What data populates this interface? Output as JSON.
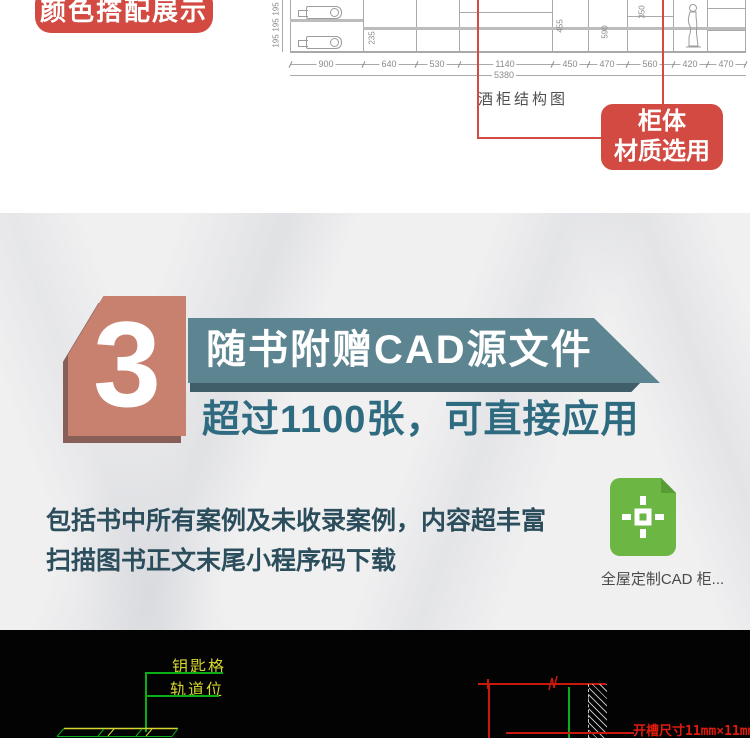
{
  "top": {
    "badge": "颜色搭配展示",
    "cad": {
      "caption": "酒柜结构图",
      "dims": [
        "900",
        "640",
        "530",
        "1140",
        "450",
        "470",
        "560",
        "420",
        "470"
      ],
      "total": "5380",
      "side_dims": [
        "195",
        "195",
        "195"
      ],
      "inner_dims": [
        "235",
        "455",
        "590",
        "350"
      ]
    },
    "material_label": {
      "line1": "柜体",
      "line2": "材质选用"
    }
  },
  "feature": {
    "number": "3",
    "banner": "随书附赠CAD源文件",
    "subtitle": "超过1100张，可直接应用",
    "body_line1": "包括书中所有案例及未收录案例，内容超丰富",
    "body_line2": "扫描图书正文末尾小程序码下载",
    "file_caption": "全屋定制CAD  柜..."
  },
  "blueprint": {
    "label_key": "钥匙格",
    "label_track": "轨道位",
    "slot_note": "开槽尺寸11mm×11mm"
  },
  "colors": {
    "accent_red": "#d24a41",
    "salmon": "#c8806f",
    "teal": "#5d8491",
    "teal_dark": "#3f5e6a",
    "teal_text": "#2e6b80",
    "body_text": "#2b4d5c",
    "file_green": "#6cb644",
    "cad_green": "#0cae18",
    "cad_yellow": "#d6d62e",
    "cad_red": "#c9190c"
  }
}
